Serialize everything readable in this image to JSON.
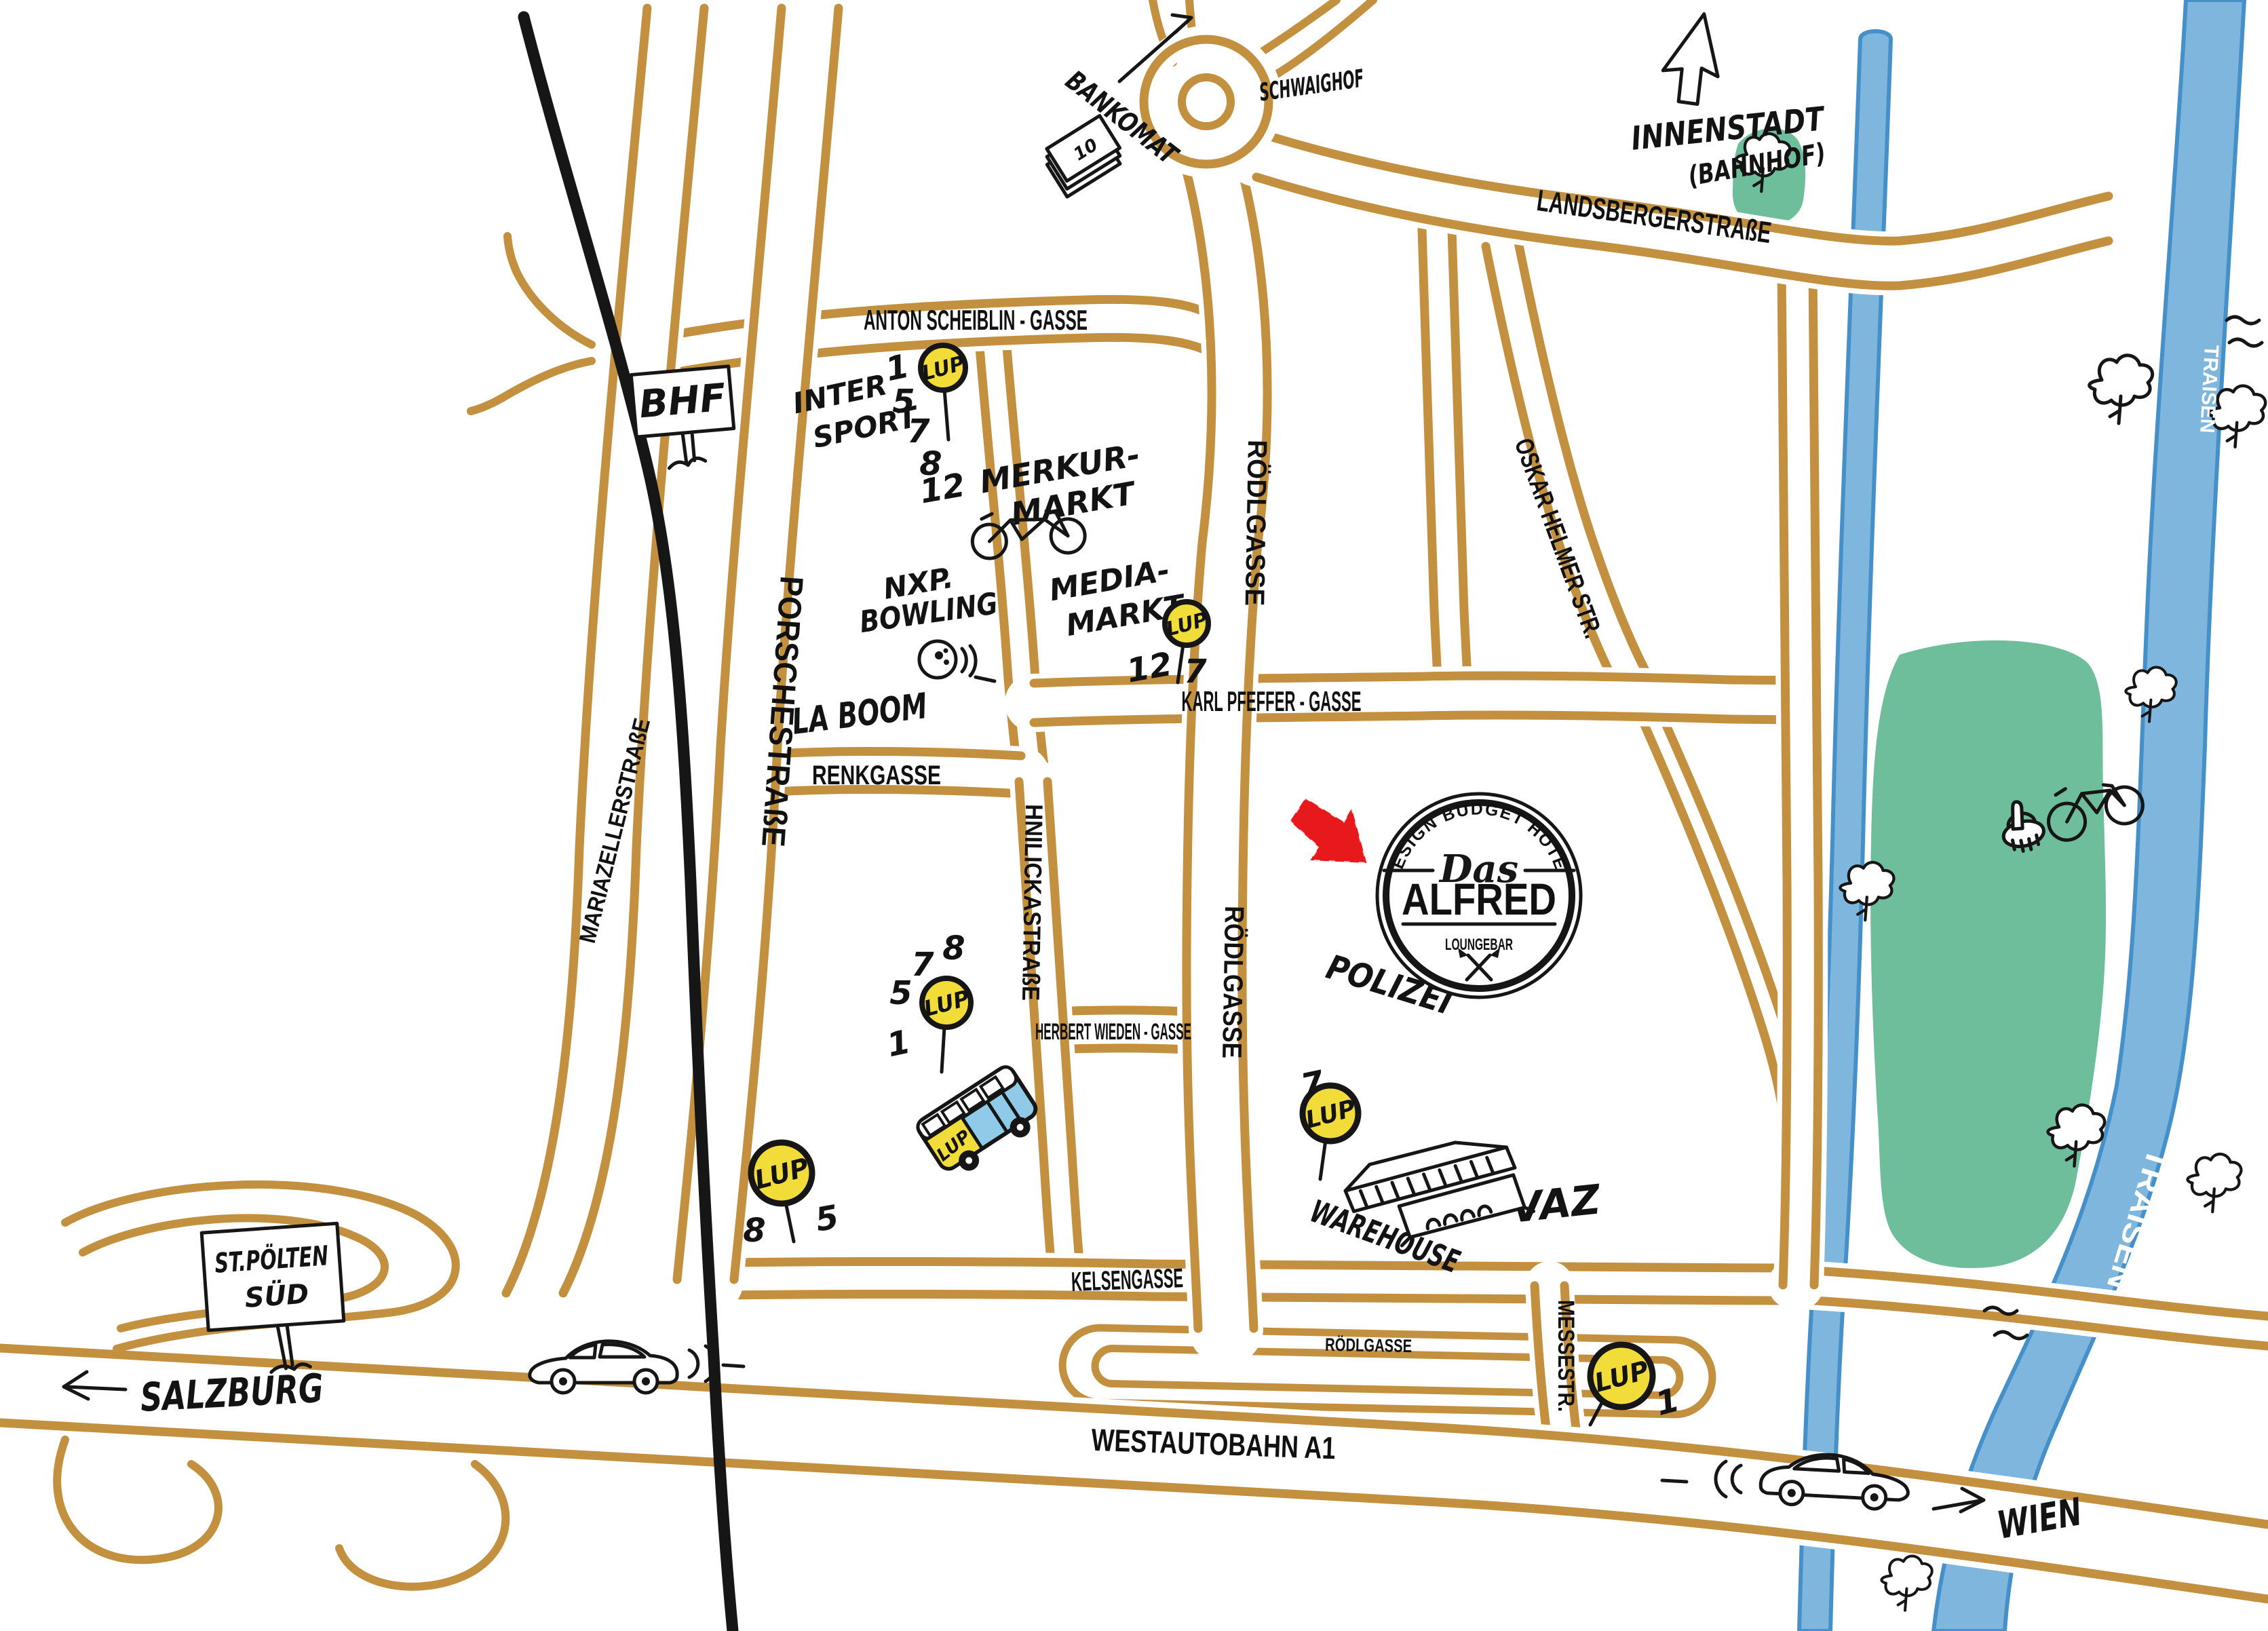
{
  "map": {
    "stamp": {
      "top": "DESIGN BUDGET HOTEL",
      "das": "Das",
      "name": "ALFRED",
      "bottom": "LOUNGEBAR"
    },
    "streets": {
      "anton_scheiblin": "ANTON SCHEIBLIN - GASSE",
      "landsberger": "LANDSBERGERSTRAßE",
      "mariazeller": "MARIAZELLERSTRAßE",
      "porsche": "PORSCHESTRAßE",
      "roedlgasse": "RÖDLGASSE",
      "roedlgasse_small": "RÖDLGASSE",
      "oskar_helmer": "OSKAR HELMER STR.",
      "karl_pfeffer": "KARL PFEFFER - GASSE",
      "renkgasse": "RENKGASSE",
      "hnilicka": "HNILICKASTRAßE",
      "herbert_wieden": "HERBERT WIEDEN - GASSE",
      "kelsengasse": "KELSENGASSE",
      "messestr": "MESSESTR.",
      "westautobahn": "WESTAUTOBAHN A1"
    },
    "places": {
      "bankomat": "BANKOMAT",
      "schwaighof": "SCHWAIGHOF",
      "innenstadt": "INNENSTADT",
      "bahnhof": "(BAHNHOF)",
      "bhf": "BHF",
      "intersport_line1": "INTER",
      "intersport_line2": "SPORT",
      "merkur_line1": "MERKUR-",
      "merkur_line2": "MARKT",
      "nxp_line1": "NXP.",
      "nxp_line2": "BOWLING",
      "media_line1": "MEDIA-",
      "media_line2": "MARKT",
      "laboom": "LA BOOM",
      "polizei": "POLIZEI",
      "warehouse": "WAREHOUSE",
      "vaz": "VAZ",
      "stpoelten_line1": "ST.PÖLTEN",
      "stpoelten_line2": "SÜD",
      "salzburg": "SALZBURG",
      "wien": "WIEN",
      "traisen": "TRAISEN"
    },
    "lup": {
      "label": "LUP",
      "bus_label": "LUP",
      "stops": [
        {
          "id": "anton-scheiblin-gasse",
          "lines": [
            "1",
            "5",
            "7",
            "8",
            "12"
          ]
        },
        {
          "id": "media-markt",
          "lines": [
            "12",
            "7"
          ]
        },
        {
          "id": "herbert-wieden-gasse",
          "lines": [
            "8",
            "7",
            "5",
            "1"
          ]
        },
        {
          "id": "kelsengasse",
          "lines": [
            "8",
            "5"
          ]
        },
        {
          "id": "warehouse",
          "lines": [
            "7"
          ]
        },
        {
          "id": "messestrasse",
          "lines": [
            "1"
          ]
        }
      ]
    },
    "banknote_value": "10",
    "colors": {
      "road": "#C2903E",
      "ink": "#161616",
      "river_fill": "#7FB6DE",
      "river_edge": "#4590C8",
      "park": "#6FBE9B",
      "lup_yellow": "#F2DC3A",
      "bus_blue": "#8FCBE9",
      "arrow_red": "#E8191C"
    }
  }
}
